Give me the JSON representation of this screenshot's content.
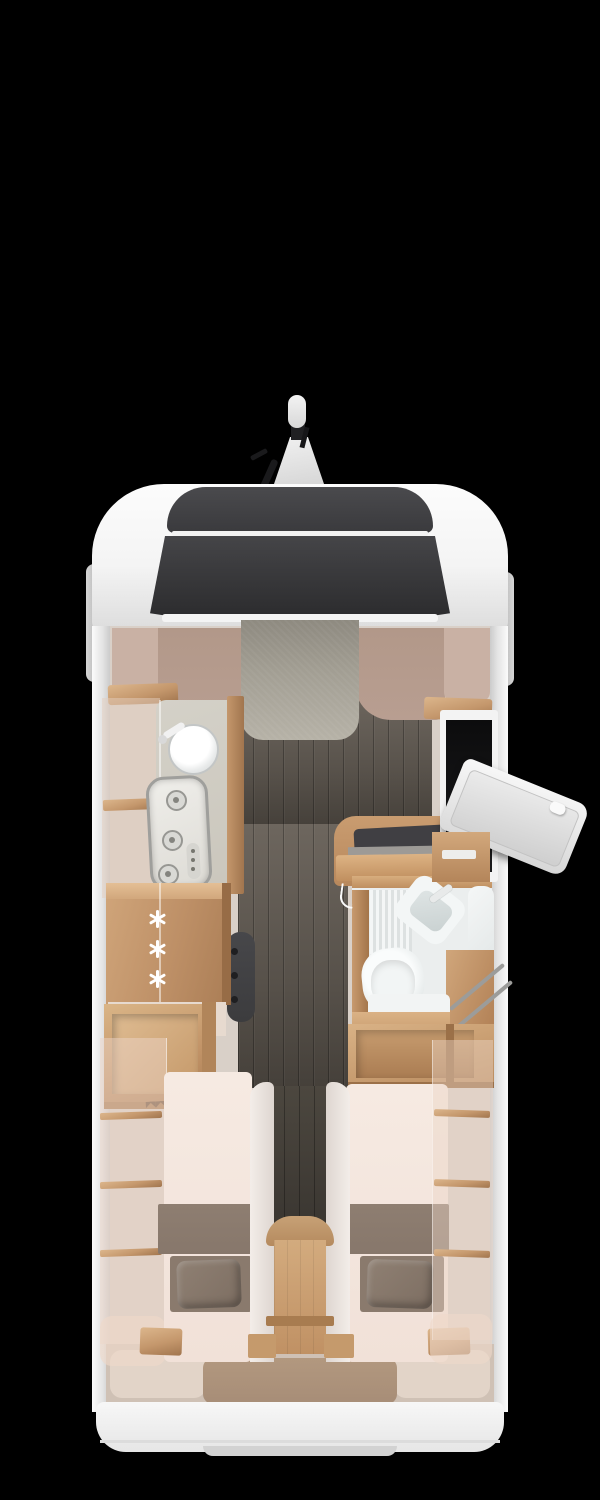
{
  "scene": {
    "description": "Top-down 3D rendered floor plan of a motorhome on black background",
    "view": "bird's-eye",
    "fridge": {
      "icon": "snowflake-icon",
      "snowflake_count": 3
    }
  },
  "colors": {
    "bg": "#000000",
    "body-white": "#f4f4f4",
    "body-shade": "#dcdcdc",
    "glass-dark": "#3a3a3d",
    "glass-darker": "#2b2b2d",
    "trim-white": "#f2f2f2",
    "rosy": "#b89e91",
    "rosy-light": "#c9b1a4",
    "fabric-gray": "#a39f94",
    "floor-dark": "#57514a",
    "wood-light": "#dcb68c",
    "wood-mid": "#c4976c",
    "wood-dark": "#a1754e",
    "counter-stone": "#cac6bc",
    "steel-gray": "#9f9f9c",
    "mattress-cream": "#f6eae2",
    "blanket-taupe": "#87776b",
    "pillow-taupe": "#7d6e62",
    "bath-white": "#ebeeee",
    "garage-beige": "#cfc1b5",
    "mat-brown": "#b2987f",
    "heater-dark": "#3c3c3e",
    "snowflake-white": "#ffffff"
  },
  "regions": {
    "vehicle": "Motorhome floor plan, top view",
    "roof_mirror": "Roof-mounted mirror assembly",
    "cab": "Driver cab with panoramic windscreen",
    "dropdown_bed": "Drop-down bed over cab",
    "kitchen": "Kitchen block",
    "sink": "Round kitchen sink",
    "hob": "Three-burner gas hob",
    "fridge": "Refrigerator / freezer cabinet",
    "heater": "Heater unit",
    "wardrobe": "Wardrobe with clothes rail",
    "bathroom": "Bathroom with toilet and washbasin",
    "toilet": "Toilet",
    "washbasin": "Washbasin",
    "entry_door": "Entry door (open)",
    "bed_left": "Rear single bed, left",
    "bed_right": "Rear single bed, right",
    "steps": "Steps between twin beds",
    "garage": "Rear garage storage",
    "rear_wall": "Rear wall and bumper"
  }
}
